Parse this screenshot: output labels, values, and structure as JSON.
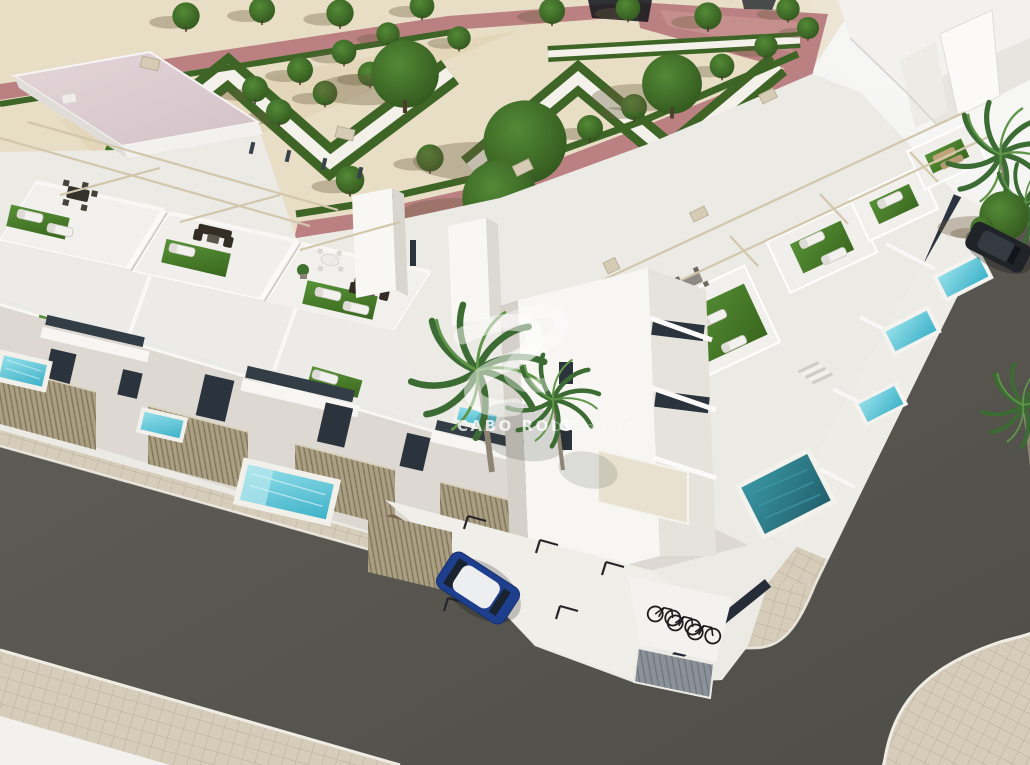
{
  "image": {
    "type": "3d-architectural-render",
    "view": "aerial-corner-view",
    "subject": "Aerial render of a modern white townhouse development with rooftop solarium terraces, artificial turf sun decks, private turquoise pools, a landscaped parterre park with hedges and trees, corner streets with parking, bicycles and palm trees"
  },
  "watermark": {
    "logo": "double-s-curve-monogram",
    "title": "CABO ROIG",
    "subtitle": "Desde 1970"
  },
  "scene": {
    "park": {
      "ground": "sand gravel",
      "walkway_color_name": "terracotta pink",
      "hedge_pattern": "zigzag parterres with white walking paths",
      "small_trees": 32,
      "large_trees": 5
    },
    "buildings": {
      "style": "white modern townhouses",
      "rows": 2,
      "rooftop_items": [
        "sun loungers",
        "dark wicker sofa sets",
        "dining sets",
        "artificial turf",
        "pergola beams",
        "glass railings",
        "air-conditioning units"
      ]
    },
    "pools": {
      "front_yard_pools": 8,
      "corner_pool": 1,
      "water": "turquoise"
    },
    "vehicles": {
      "cars": [
        "blue hatchback in parking bay",
        "bronze car behind slatted fence",
        "dark SUV on right street"
      ],
      "bicycles": 3
    },
    "streets": {
      "surface": "asphalt",
      "sidewalk": "beige pavers",
      "corner": "rounded curb"
    },
    "vegetation": {
      "palm_trees": 5
    }
  },
  "colors": {
    "bg1": "#e8e7e5",
    "bg2": "#f7f7f6",
    "sand": "#e8ddc5",
    "sandshade": "#ddcfae",
    "pink": "#bb8182",
    "pinklight": "#cd9b97",
    "hedge": "#3e6426",
    "parkpath": "#f3f1ea",
    "tree1": "#538a36",
    "tree2": "#31551d",
    "roofpink1": "#e4d5d9",
    "roofpink2": "#d3c3c9",
    "white1": "#f7f6f3",
    "white2": "#eceae5",
    "white3": "#ddd8d1",
    "shadow1": "#c9c5bf",
    "turf1": "#579237",
    "turf2": "#3a671e",
    "pool1": "#93dfe9",
    "pool2": "#3fb2c9",
    "poolc1": "#3a96a3",
    "poolc2": "#22606c",
    "asphalt1": "#615f58",
    "asphalt2": "#4f4d47",
    "paver": "#d6ccba",
    "paverline": "#b9ae9b",
    "curb": "#efece4",
    "fence": "#ab9f83",
    "fenceline": "#7d7258",
    "glass": "#2b343c",
    "glasslight": "#4b5a64",
    "dark": "#2e2a24",
    "beam": "#d2c7ac",
    "door": "#8b9199",
    "navy": "#262d39",
    "carblue": "#1e3f8e",
    "carbronze": "#7b6a50",
    "cardark": "#202429",
    "palm": "#3c6b33",
    "palmlight": "#5f9549",
    "trunk": "#8d8473",
    "wm": "#ffffff"
  }
}
